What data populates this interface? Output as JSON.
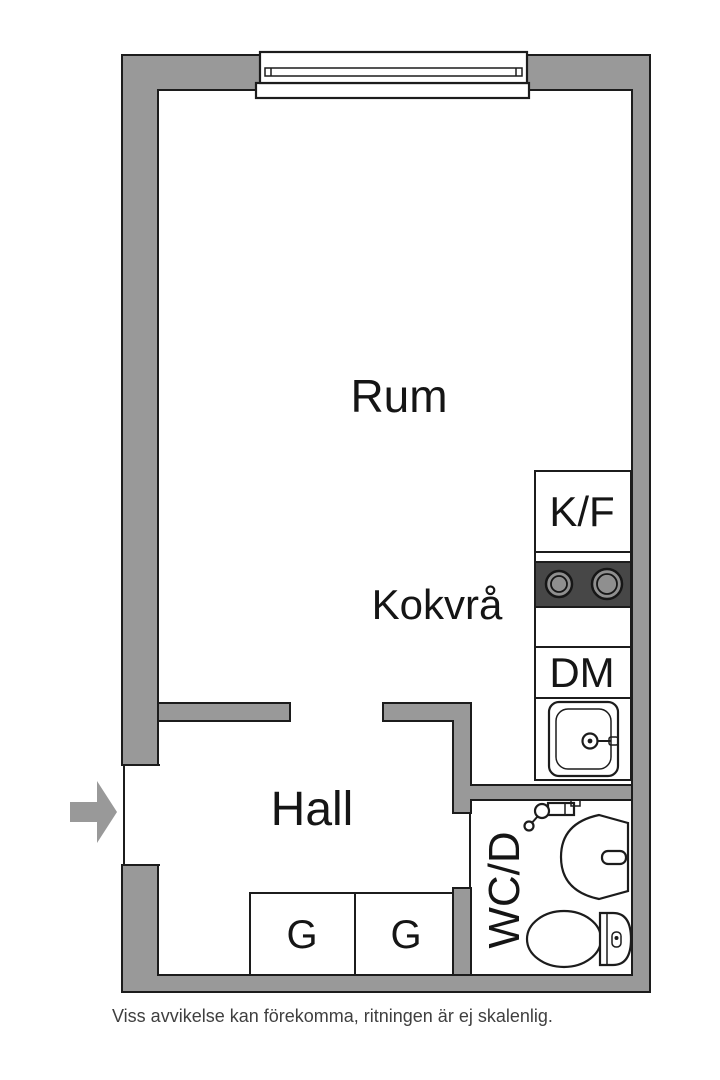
{
  "labels": {
    "main_room": "Rum",
    "kitchenette": "Kokvrå",
    "hall": "Hall",
    "bathroom": "WC/D",
    "fridge_freezer": "K/F",
    "dishwasher": "DM",
    "wardrobe_left": "G",
    "wardrobe_right": "G"
  },
  "footer": {
    "disclaimer": "Viss avvikelse kan förekomma, ritningen är ej skalenlig."
  },
  "icons": {
    "entrance": "entrance-arrow-icon",
    "window": "window-icon",
    "stove": "stove-icon",
    "kitchen_sink": "sink-icon",
    "shower_mixer": "shower-mixer-icon",
    "washbasin": "washbasin-icon",
    "toilet": "toilet-icon"
  },
  "colors": {
    "wall": "#999999",
    "outline": "#1c1c1c",
    "stove": "#474747",
    "burner": "#8f8f8f",
    "text": "#151515",
    "disclaimer": "#3f3f3f",
    "bg": "#ffffff"
  }
}
